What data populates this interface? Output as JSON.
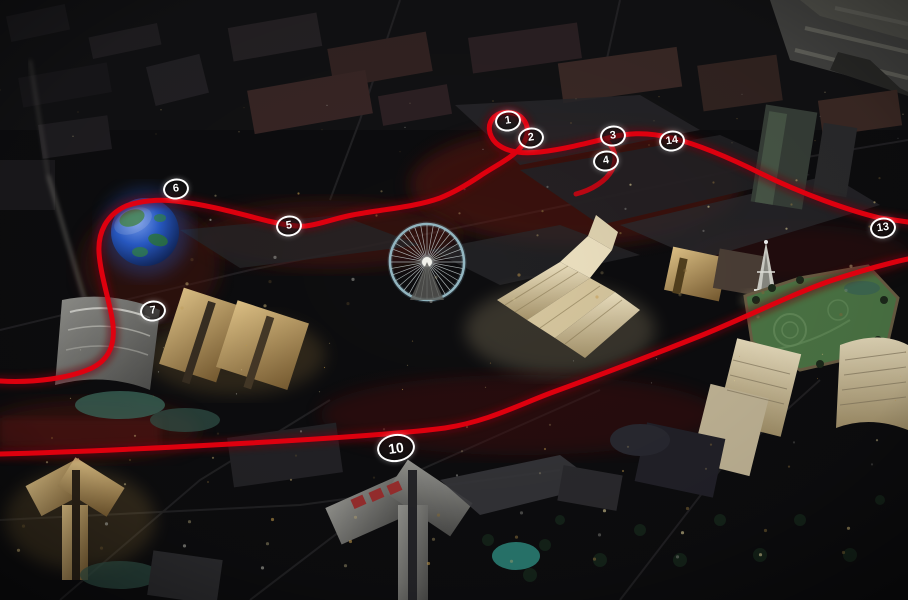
{
  "scene": {
    "kind": "aerial-night-city-render",
    "overlay": "racing-circuit-route"
  },
  "track": {
    "color": "#e3000f",
    "glow": "#6d0007",
    "marker_border": "#ffffff",
    "marker_fill": "rgba(25,22,22,0.5)",
    "marker_text": "#ffffff",
    "markers": [
      {
        "label": "1",
        "x": 508,
        "y": 121,
        "large": false
      },
      {
        "label": "2",
        "x": 531,
        "y": 138,
        "large": false
      },
      {
        "label": "3",
        "x": 613,
        "y": 136,
        "large": false
      },
      {
        "label": "4",
        "x": 606,
        "y": 161,
        "large": false
      },
      {
        "label": "5",
        "x": 289,
        "y": 226,
        "large": false
      },
      {
        "label": "6",
        "x": 176,
        "y": 189,
        "large": false
      },
      {
        "label": "7",
        "x": 153,
        "y": 311,
        "large": false
      },
      {
        "label": "10",
        "x": 396,
        "y": 448,
        "large": true
      },
      {
        "label": "13",
        "x": 883,
        "y": 228,
        "large": false
      },
      {
        "label": "14",
        "x": 672,
        "y": 141,
        "large": false
      }
    ]
  },
  "palette": {
    "ground": "#0d0d0f",
    "lot_gray": "#29282b",
    "runway_gray": "#4a4a47",
    "red_glow": "#5e1511",
    "gold_building": "#c9a869",
    "cream_building": "#e2d5b2",
    "white_building": "#d9d9d3",
    "sphere_blue": "#2a5fd0",
    "sphere_green": "#2e7d3a",
    "wheel_rim": "#a8cdd8",
    "lawn_green": "#4f7a48",
    "lagoon_teal": "#2f8b80"
  }
}
